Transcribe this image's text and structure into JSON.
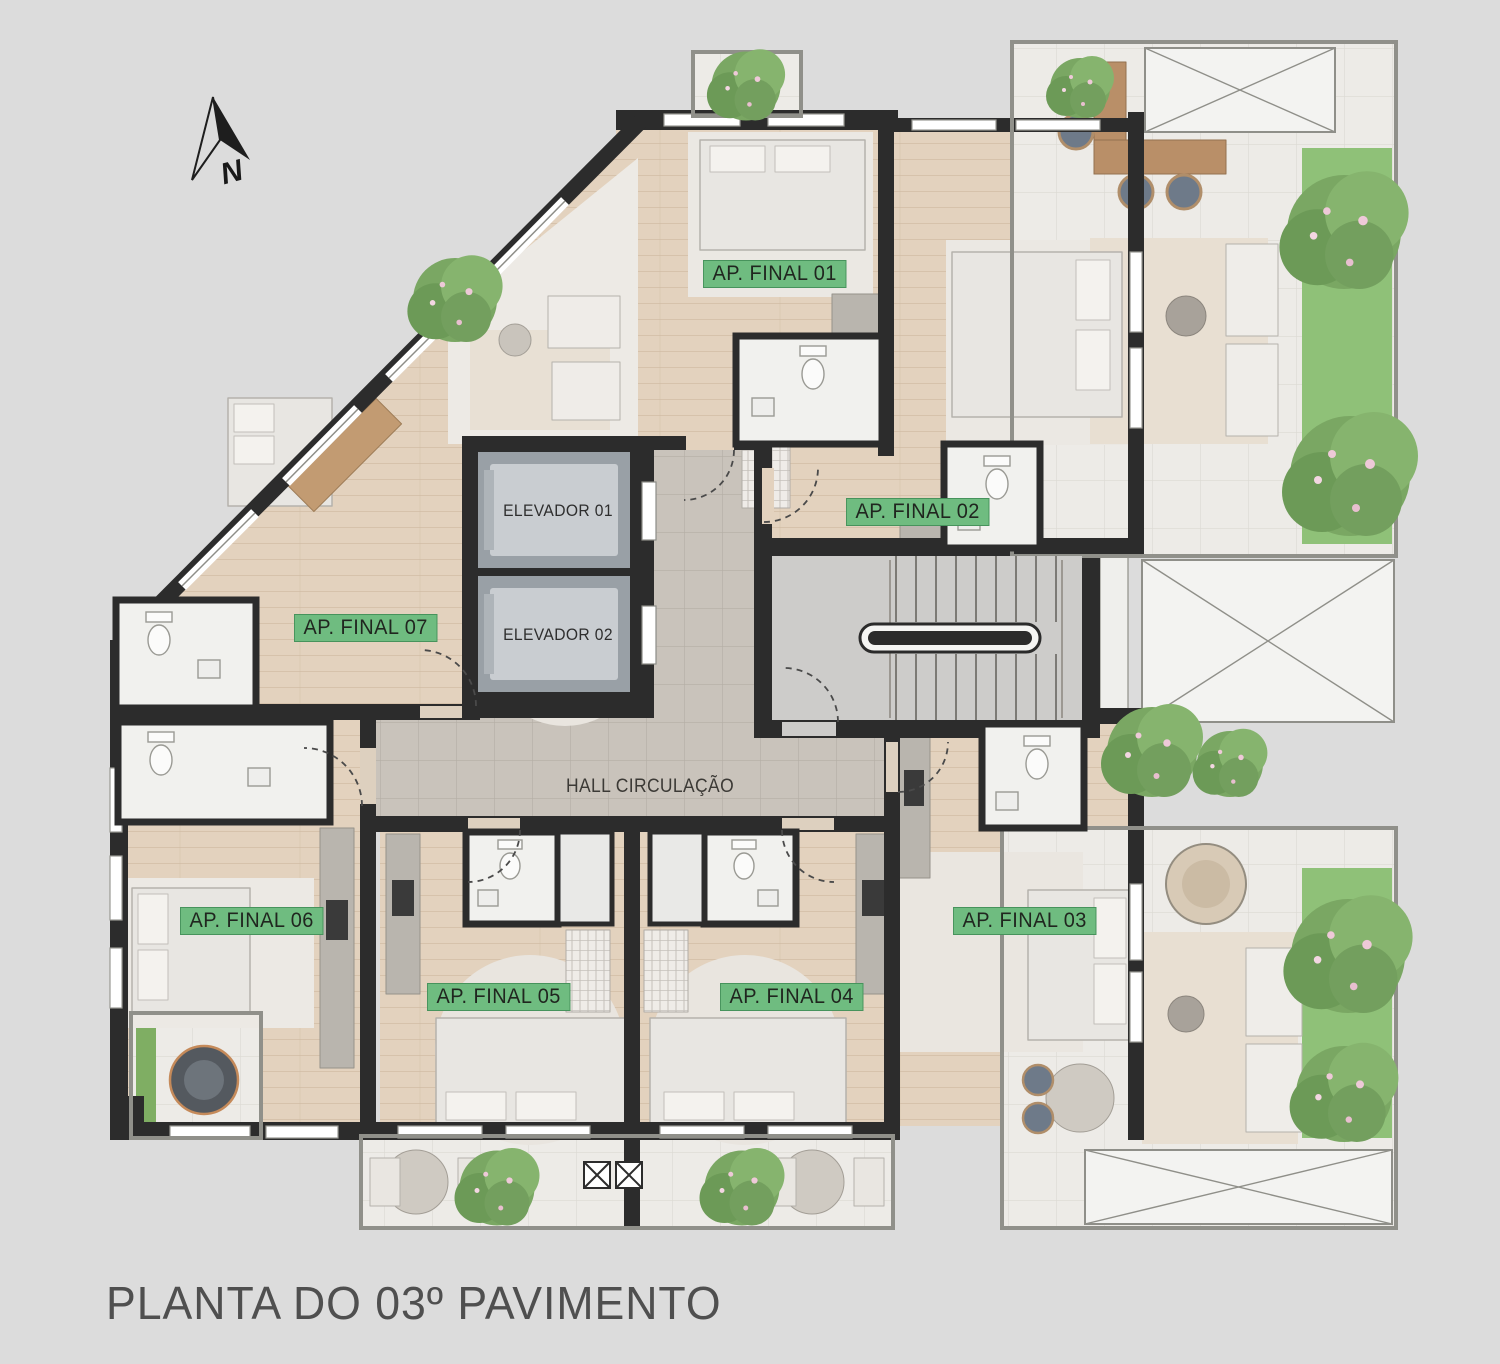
{
  "title": "PLANTA DO 03º PAVIMENTO",
  "compass": {
    "label": "N"
  },
  "hall": {
    "label": "HALL CIRCULAÇÃO"
  },
  "elevators": [
    {
      "label": "ELEVADOR 01"
    },
    {
      "label": "ELEVADOR 02"
    }
  ],
  "apartments": [
    {
      "label": "AP. FINAL 01"
    },
    {
      "label": "AP. FINAL 02"
    },
    {
      "label": "AP. FINAL 03"
    },
    {
      "label": "AP. FINAL 04"
    },
    {
      "label": "AP. FINAL 05"
    },
    {
      "label": "AP. FINAL 06"
    },
    {
      "label": "AP. FINAL 07"
    }
  ],
  "colors": {
    "background": "#dcdcdc",
    "wall": "#2c2c2c",
    "wood_floor": "#e3d2be",
    "hall_tile": "#c9c3bb",
    "stair_concrete": "#cdccca",
    "terrace_tile": "#edebe7",
    "grass": "#8fc178",
    "label_bg": "#6fbc80",
    "elevator_cabin": "#c9cdd1"
  }
}
